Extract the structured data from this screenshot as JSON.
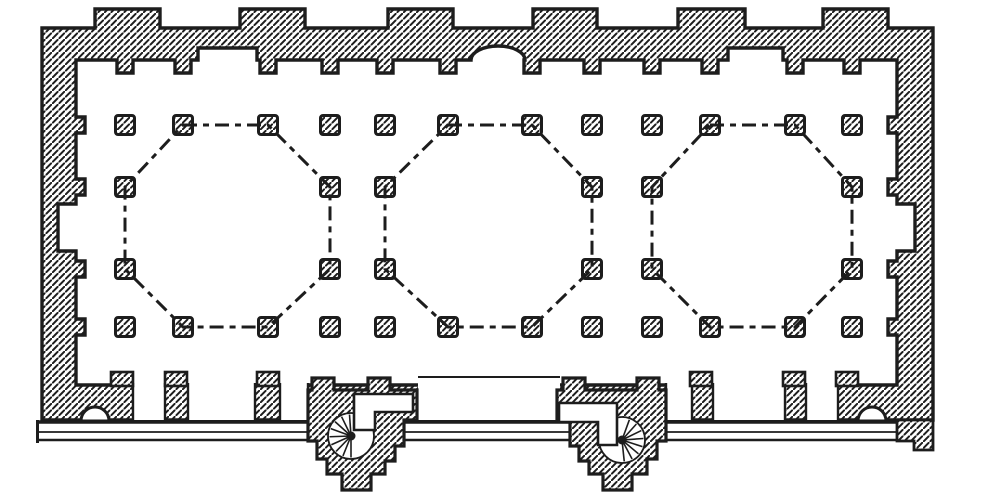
{
  "figure": {
    "kind": "architectural-floor-plan",
    "description": "Engraved ground plan of a rectangular columned hall with three domed octagonal bays marked by dash-dot lines, hatched masonry walls with exterior buttresses, wall pilasters, lateral niches, a central apse niche, a stepped entrance porch and two projecting spiral-staircase towers",
    "paper": "#ffffff",
    "ink": "#1d1d1d",
    "hatch": {
      "spacing": 6.5,
      "line_width": 2
    }
  },
  "canvas": {
    "width": 1000,
    "height": 498
  },
  "walls": {
    "stroke_width": 3.4,
    "outer": [
      42,
      28,
      933,
      420
    ],
    "inner": [
      76,
      60,
      897,
      385
    ],
    "buttresses": {
      "top_y": 9,
      "spans": [
        [
          95,
          160
        ],
        [
          240,
          305
        ],
        [
          388,
          453
        ],
        [
          533,
          597
        ],
        [
          678,
          745
        ],
        [
          823,
          888
        ]
      ]
    },
    "top_face": {
      "pilaster_cols": [
        125,
        183,
        268,
        330,
        385,
        448,
        532,
        592,
        652,
        710,
        795,
        852
      ],
      "pilaster_half_width": 8,
      "pilaster_depth": 13,
      "recesses": [
        [
          198,
          257
        ],
        [
          728,
          783
        ]
      ],
      "recess_depth": 12,
      "niche": {
        "cx": 498,
        "rx": 27,
        "ry": 14
      }
    },
    "side_face": {
      "pilaster_rows": [
        125,
        187,
        269,
        327
      ],
      "pilaster_half_width": 8,
      "pilaster_depth": 9,
      "recess_span": [
        204,
        251
      ],
      "recess_depth": 18
    }
  },
  "bottom": {
    "openings": [
      [
        133,
        165
      ],
      [
        188,
        255
      ],
      [
        280,
        308
      ],
      [
        666,
        692
      ],
      [
        713,
        785
      ],
      [
        806,
        838
      ]
    ],
    "portal": {
      "span": [
        418,
        560
      ],
      "lintel_y": 377
    },
    "pilasters": {
      "centers": [
        122,
        176,
        268,
        701,
        794,
        847
      ],
      "half_width": 11,
      "top_y": 372,
      "height": 14
    },
    "plinth_arches": {
      "radius": 14,
      "base_y": 421,
      "centers": [
        95,
        872
      ]
    },
    "steps": {
      "x1": 36,
      "x2": 928,
      "lines": [
        [
          422,
          3.6
        ],
        [
          432,
          1.8
        ],
        [
          440,
          2.6
        ]
      ],
      "left_cap_x": 37.5,
      "right_cap_x": 926.5,
      "cap_y1": 420,
      "cap_y2": 443
    },
    "right_corner_foot": [
      [
        897,
        420
      ],
      [
        933,
        420
      ],
      [
        933,
        450
      ],
      [
        914,
        450
      ],
      [
        914,
        441
      ],
      [
        897,
        441
      ]
    ]
  },
  "piers": {
    "size": 19,
    "corner_radius": 2.5,
    "stroke_width": 3,
    "full_rows_y": [
      125,
      327
    ],
    "full_row_cols_x": [
      125,
      183,
      268,
      330,
      385,
      448,
      532,
      592,
      652,
      710,
      795,
      852
    ],
    "mid_rows_y": [
      187,
      269
    ],
    "mid_row_cols_x": [
      125,
      330,
      385,
      592,
      652,
      852
    ]
  },
  "domes": {
    "stroke_width": 3,
    "dash_pattern": "14 6 6 6",
    "octagons": [
      [
        [
          183,
          125
        ],
        [
          268,
          125
        ],
        [
          330,
          187
        ],
        [
          330,
          269
        ],
        [
          268,
          327
        ],
        [
          183,
          327
        ],
        [
          125,
          269
        ],
        [
          125,
          187
        ]
      ],
      [
        [
          448,
          125
        ],
        [
          532,
          125
        ],
        [
          592,
          187
        ],
        [
          592,
          269
        ],
        [
          532,
          327
        ],
        [
          448,
          327
        ],
        [
          385,
          269
        ],
        [
          385,
          187
        ]
      ],
      [
        [
          710,
          125
        ],
        [
          795,
          125
        ],
        [
          852,
          187
        ],
        [
          852,
          269
        ],
        [
          795,
          327
        ],
        [
          710,
          327
        ],
        [
          652,
          269
        ],
        [
          652,
          187
        ]
      ]
    ]
  },
  "stair_towers": [
    {
      "id": "left",
      "outline": [
        [
          308,
          390
        ],
        [
          312,
          390
        ],
        [
          312,
          378
        ],
        [
          334,
          378
        ],
        [
          334,
          390
        ],
        [
          368,
          390
        ],
        [
          368,
          378
        ],
        [
          390,
          378
        ],
        [
          390,
          390
        ],
        [
          417,
          390
        ],
        [
          417,
          420
        ],
        [
          404,
          420
        ],
        [
          404,
          446
        ],
        [
          395,
          446
        ],
        [
          395,
          461
        ],
        [
          385,
          461
        ],
        [
          385,
          474
        ],
        [
          371,
          474
        ],
        [
          371,
          490
        ],
        [
          342,
          490
        ],
        [
          342,
          474
        ],
        [
          327,
          474
        ],
        [
          327,
          459
        ],
        [
          317,
          459
        ],
        [
          317,
          441
        ],
        [
          308,
          441
        ]
      ],
      "passage": [
        [
          354,
          394
        ],
        [
          413,
          394
        ],
        [
          413,
          412
        ],
        [
          375,
          412
        ],
        [
          375,
          430
        ],
        [
          354,
          430
        ]
      ],
      "stairwell": {
        "cx": 351,
        "cy": 436,
        "r": 23
      },
      "spoke_angles_deg": [
        90,
        112,
        134,
        156,
        178,
        200,
        222,
        244,
        266
      ],
      "newel_r": 4.5
    },
    {
      "id": "right",
      "outline": [
        [
          557,
          390
        ],
        [
          563,
          390
        ],
        [
          563,
          378
        ],
        [
          585,
          378
        ],
        [
          585,
          390
        ],
        [
          637,
          390
        ],
        [
          637,
          378
        ],
        [
          659,
          378
        ],
        [
          659,
          390
        ],
        [
          666,
          390
        ],
        [
          666,
          441
        ],
        [
          657,
          441
        ],
        [
          657,
          459
        ],
        [
          647,
          459
        ],
        [
          647,
          474
        ],
        [
          632,
          474
        ],
        [
          632,
          490
        ],
        [
          603,
          490
        ],
        [
          603,
          474
        ],
        [
          589,
          474
        ],
        [
          589,
          461
        ],
        [
          579,
          461
        ],
        [
          579,
          446
        ],
        [
          570,
          446
        ],
        [
          570,
          420
        ],
        [
          557,
          420
        ]
      ],
      "passage": [
        [
          559,
          403
        ],
        [
          617,
          403
        ],
        [
          617,
          445
        ],
        [
          598,
          445
        ],
        [
          598,
          422
        ],
        [
          559,
          422
        ]
      ],
      "stairwell": {
        "cx": 622,
        "cy": 440,
        "r": 23
      },
      "spoke_angles_deg": [
        -70,
        -48,
        -26,
        -4,
        18,
        40,
        62,
        84
      ],
      "newel_r": 4.5
    }
  ]
}
